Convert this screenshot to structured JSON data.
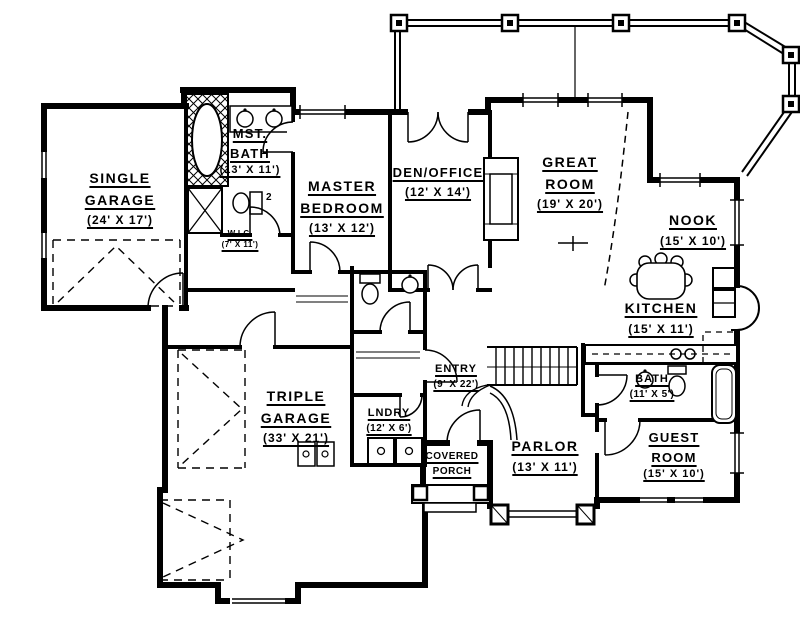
{
  "plan": {
    "rooms": {
      "single_garage": {
        "lines": [
          "SINGLE",
          "GARAGE"
        ],
        "dims": "(24' X 17')"
      },
      "mst_bath": {
        "lines": [
          "MST.",
          "BATH"
        ],
        "dims": "(13' X 11')"
      },
      "wic": {
        "lines": [
          "W.I.C."
        ],
        "dims": "(7' X 11')"
      },
      "master_bedroom": {
        "lines": [
          "MASTER",
          "BEDROOM"
        ],
        "dims": "(13' X 12')"
      },
      "den_office": {
        "lines": [
          "DEN/OFFICE"
        ],
        "dims": "(12' X 14')"
      },
      "great_room": {
        "lines": [
          "GREAT",
          "ROOM"
        ],
        "dims": "(19' X 20')"
      },
      "nook": {
        "lines": [
          "NOOK"
        ],
        "dims": "(15' X 10')"
      },
      "kitchen": {
        "lines": [
          "KITCHEN"
        ],
        "dims": "(15' X 11')"
      },
      "triple_garage": {
        "lines": [
          "TRIPLE",
          "GARAGE"
        ],
        "dims": "(33' X 21')"
      },
      "lndry": {
        "lines": [
          "LNDRY"
        ],
        "dims": "(12' X 6')"
      },
      "entry": {
        "lines": [
          "ENTRY"
        ],
        "dims": "(9' X 22')"
      },
      "covered_porch": {
        "lines": [
          "COVERED",
          "PORCH"
        ],
        "dims": ""
      },
      "parlor": {
        "lines": [
          "PARLOR"
        ],
        "dims": "(13' X 11')"
      },
      "bath": {
        "lines": [
          "BATH"
        ],
        "dims": "(11' X 5')"
      },
      "guest_room": {
        "lines": [
          "GUEST",
          "ROOM"
        ],
        "dims": "(15' X 10')"
      }
    },
    "annotations": {
      "door_tag": "2"
    },
    "colors": {
      "ink": "#000000",
      "paper": "#ffffff"
    }
  }
}
